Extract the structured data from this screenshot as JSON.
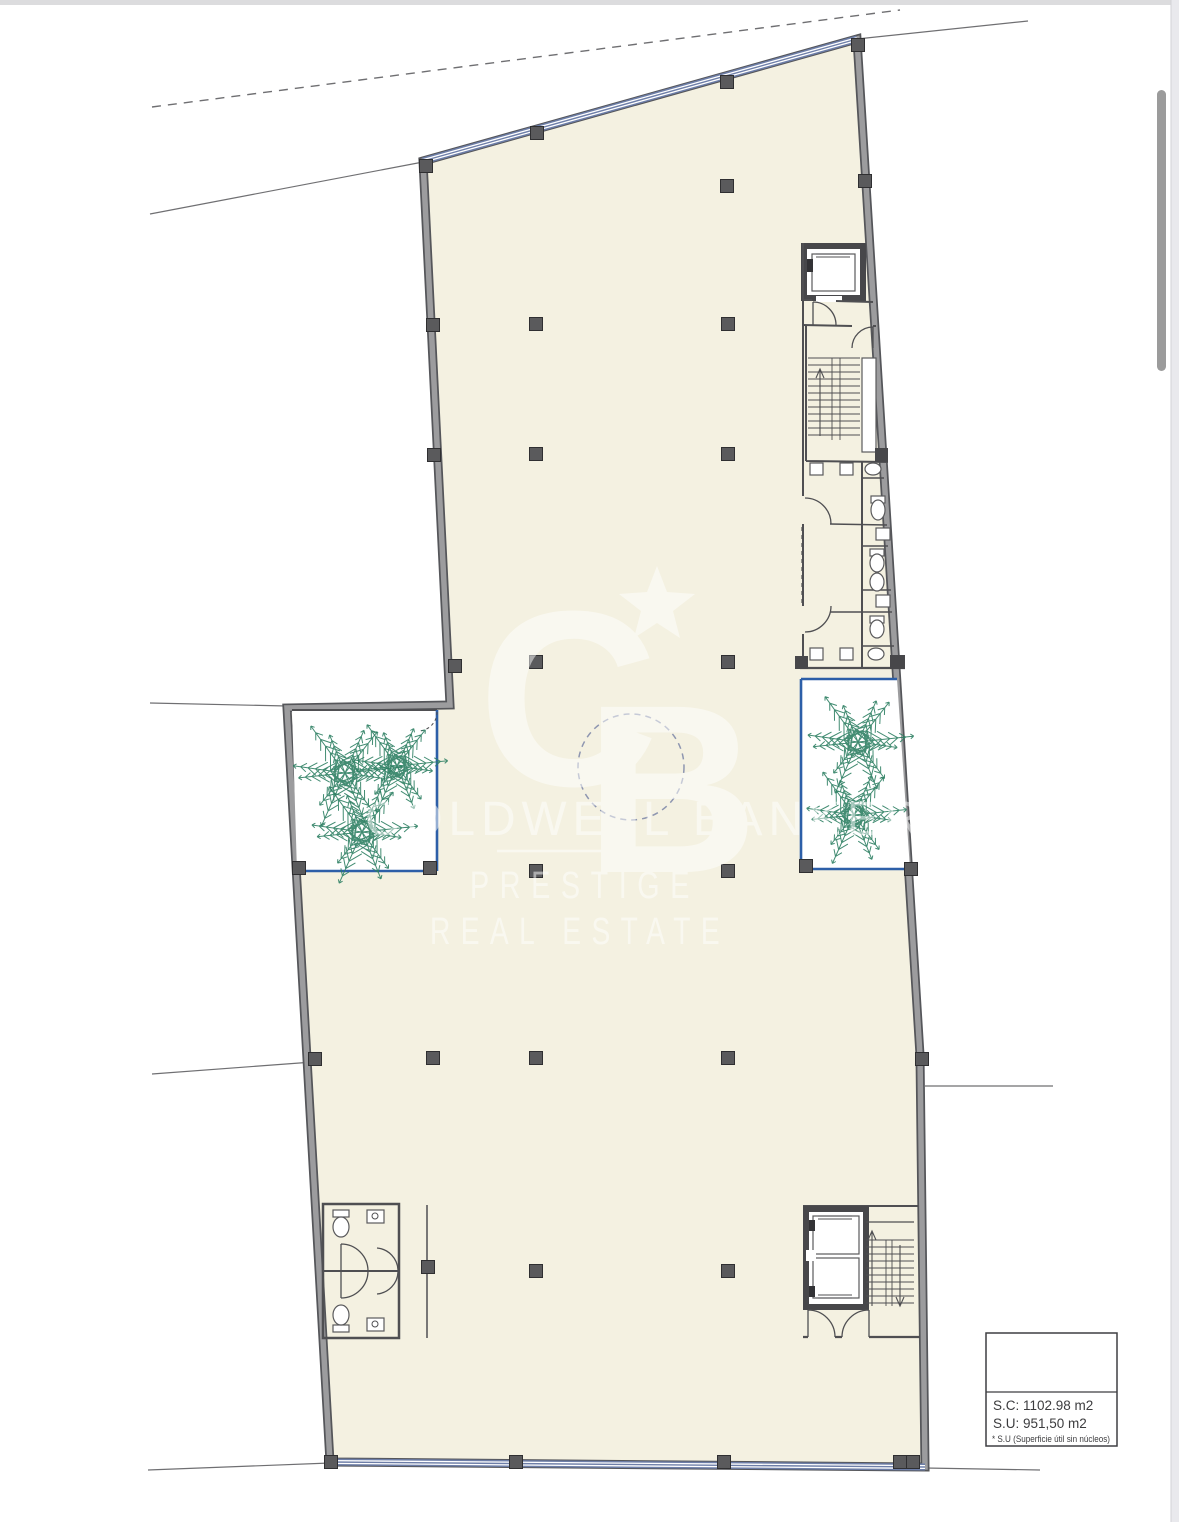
{
  "page": {
    "background": "#ffffff",
    "top_strip_color": "#dcdcde",
    "right_edge_color": "#e9e9ed"
  },
  "scrollbar": {
    "thumb_color": "#9b9b9b"
  },
  "plan": {
    "floor_color": "#f4f1e1",
    "wall_color": "#9c9c9e",
    "wall_edge_color": "#55565a",
    "partition_color": "#4f4f52",
    "glazing_color": "#6d7ea8",
    "patio_border_color": "#2d5fa8",
    "palm_color": "#2e7f63",
    "column_color": "#5a5a5c",
    "dashed_circle_color": "#8e96b0",
    "palms": [
      {
        "cx": 345,
        "cy": 773,
        "r": 57
      },
      {
        "cx": 397,
        "cy": 766,
        "r": 50
      },
      {
        "cx": 362,
        "cy": 832,
        "r": 55
      },
      {
        "cx": 858,
        "cy": 742,
        "r": 55
      },
      {
        "cx": 854,
        "cy": 815,
        "r": 52
      }
    ],
    "columns": [
      [
        426,
        166
      ],
      [
        537,
        133
      ],
      [
        727,
        82
      ],
      [
        858,
        45
      ],
      [
        865,
        181
      ],
      [
        727,
        186
      ],
      [
        433,
        325
      ],
      [
        536,
        324
      ],
      [
        728,
        324
      ],
      [
        434,
        455
      ],
      [
        536,
        454
      ],
      [
        728,
        454
      ],
      [
        455,
        666
      ],
      [
        536,
        662
      ],
      [
        728,
        662
      ],
      [
        299,
        868
      ],
      [
        430,
        868
      ],
      [
        536,
        871
      ],
      [
        728,
        871
      ],
      [
        806,
        866
      ],
      [
        911,
        869
      ],
      [
        315,
        1059
      ],
      [
        433,
        1058
      ],
      [
        536,
        1058
      ],
      [
        728,
        1058
      ],
      [
        922,
        1059
      ],
      [
        428,
        1267
      ],
      [
        536,
        1271
      ],
      [
        728,
        1271
      ],
      [
        331,
        1462
      ],
      [
        516,
        1462
      ],
      [
        724,
        1462
      ],
      [
        900,
        1462
      ],
      [
        913,
        1462
      ]
    ]
  },
  "watermark": {
    "logo_letter_c": "C",
    "logo_letter_b": "B",
    "brand": "COLDWELL BANKER",
    "line2": "PRESTIGE",
    "line3": "REAL ESTATE",
    "color": "#ffffff"
  },
  "legend": {
    "sc": "S.C: 1102.98 m2",
    "su": "S.U:  951,50 m2",
    "note": "* S.U (Superficie útil sin núcleos)"
  }
}
